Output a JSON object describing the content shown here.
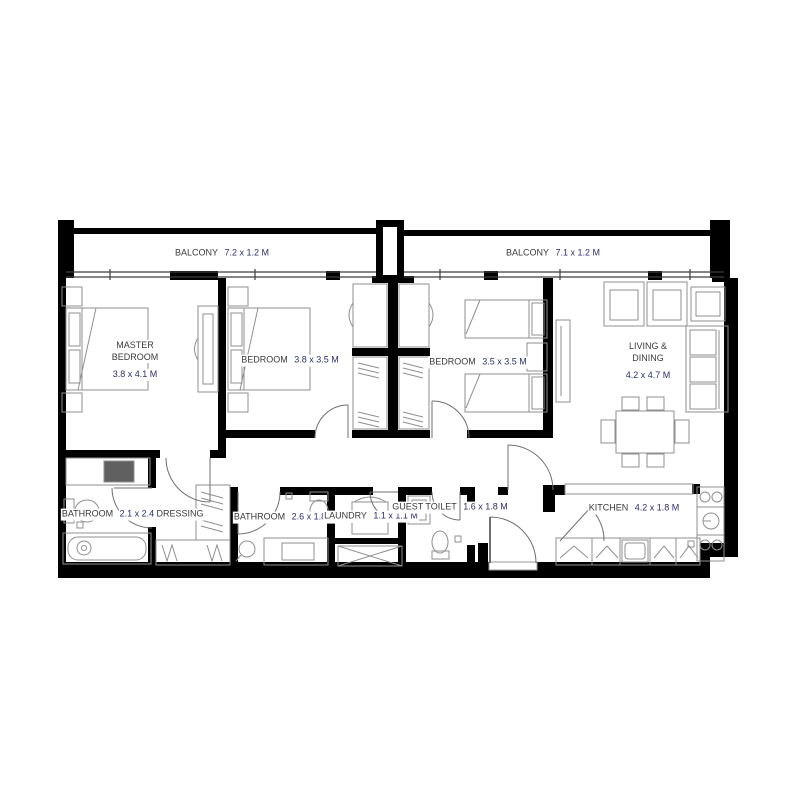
{
  "plan_type": "apartment floor plan",
  "colors": {
    "wall": "#000000",
    "furniture_line": "#8f8f8f",
    "door_line": "#6f6f6f",
    "room_name": "#3a3a3a",
    "dimension_text": "#2a3070",
    "background": "#ffffff"
  },
  "rooms": {
    "balcony_left": {
      "name": "BALCONY",
      "dims": "7.2 x 1.2 M"
    },
    "balcony_right": {
      "name": "BALCONY",
      "dims": "7.1 x 1.2 M"
    },
    "master_bedroom": {
      "name": "MASTER BEDROOM",
      "dims": "3.8 x 4.1 M"
    },
    "bedroom_2": {
      "name": "BEDROOM",
      "dims": "3.8 x 3.5 M"
    },
    "bedroom_3": {
      "name": "BEDROOM",
      "dims": "3.5 x 3.5 M"
    },
    "living_dining": {
      "name": "LIVING & DINING",
      "dims": "4.2 x 4.7 M"
    },
    "bathroom_master": {
      "name": "BATHROOM",
      "dims": "2.1 x 2.4 M"
    },
    "dressing": {
      "name": "DRESSING",
      "dims": ""
    },
    "bathroom_2": {
      "name": "BATHROOM",
      "dims": "2.6 x 1.8 M"
    },
    "laundry": {
      "name": "LAUNDRY",
      "dims": "1.1 x 1.1 M"
    },
    "guest_toilet": {
      "name": "GUEST TOILET",
      "dims": "1.6 x 1.8 M"
    },
    "kitchen": {
      "name": "KITCHEN",
      "dims": "4.2 x 1.8 M"
    }
  }
}
